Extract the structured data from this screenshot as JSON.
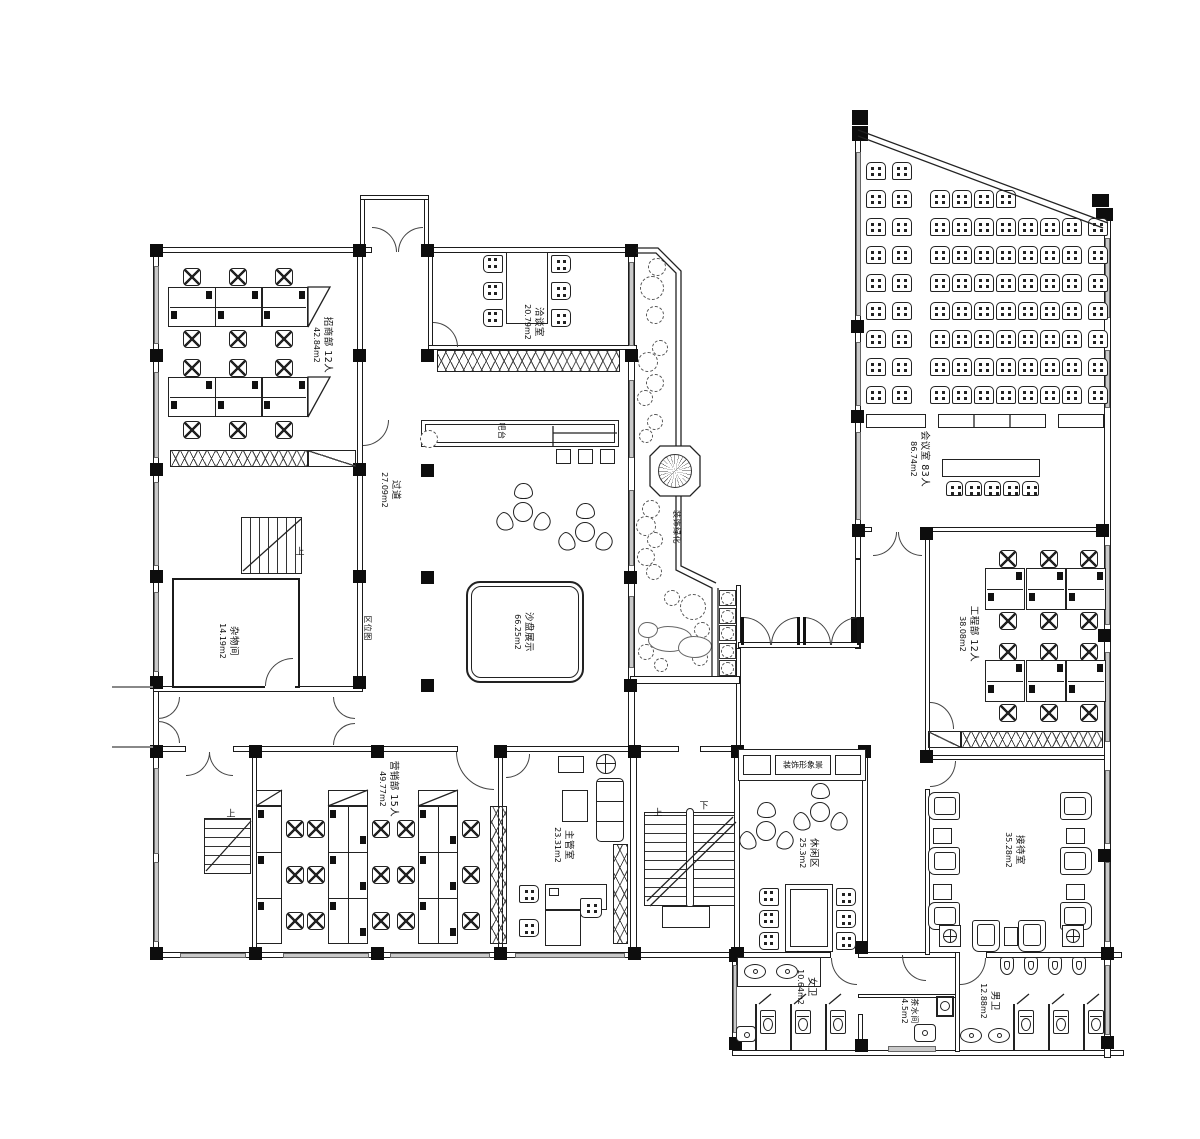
{
  "colors": {
    "ink": "#1b1b1b",
    "glass": "#c9c9c9"
  },
  "rooms": {
    "zhaoshang": {
      "name": "招商部 12人",
      "area": "42.84m2"
    },
    "qiatan": {
      "name": "洽谈室",
      "area": "20.79m2"
    },
    "guodao": {
      "name": "过道",
      "area": "27.09m2"
    },
    "zawu": {
      "name": "杂物间",
      "area": "14.19m2"
    },
    "quweitu": {
      "name": "区位图"
    },
    "batai": {
      "name": "吧台"
    },
    "shapan": {
      "name": "沙盘展示",
      "area": "66.25m2"
    },
    "lvhua": {
      "name": "装饰绿化"
    },
    "huiyi": {
      "name": "会议室 83人",
      "area": "86.74m2"
    },
    "gongcheng": {
      "name": "工程部 12人",
      "area": "38.08m2"
    },
    "yingxiao": {
      "name": "营销部 15人",
      "area": "49.77m2"
    },
    "zhuguan": {
      "name": "主管室",
      "area": "23.31m2"
    },
    "xiuxian": {
      "name": "休闲区",
      "area": "25.3m2"
    },
    "xingxiang": {
      "name": "装饰形象景"
    },
    "jiedai": {
      "name": "接待室",
      "area": "35.28m2"
    },
    "nvwei": {
      "name": "女卫",
      "area": "10.64m2"
    },
    "chashui": {
      "name": "茶水间",
      "area": "4.5m2"
    },
    "nanwei": {
      "name": "男卫",
      "area": "12.88m2"
    }
  },
  "stairs": {
    "up": "上",
    "down": "下"
  }
}
